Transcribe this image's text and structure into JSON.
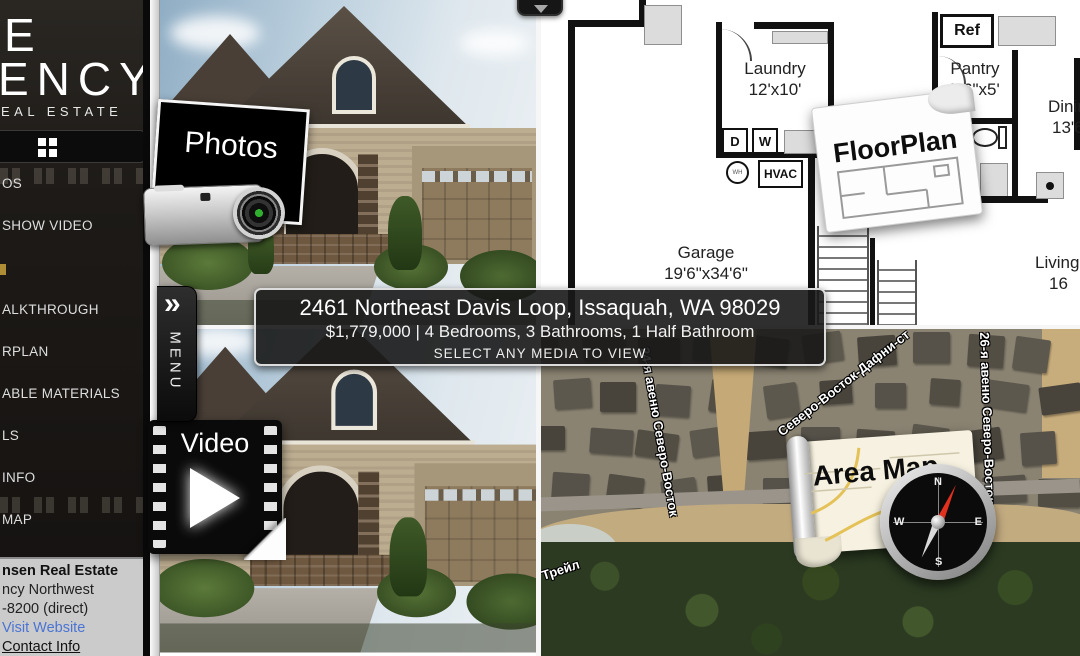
{
  "brand": {
    "logo_line1": "E",
    "logo_line2": "ENCY",
    "logo_line3": "EAL ESTATE"
  },
  "sidebar": {
    "items": [
      {
        "label": "OS"
      },
      {
        "label": "SHOW VIDEO"
      },
      {
        "label": "ALKTHROUGH"
      },
      {
        "label": "RPLAN"
      },
      {
        "label": "ABLE MATERIALS"
      },
      {
        "label": "LS"
      },
      {
        "label": "INFO"
      },
      {
        "label": "MAP"
      }
    ],
    "contact": {
      "line1": "nsen Real Estate",
      "line2": "ncy Northwest",
      "line3": "-8200 (direct)",
      "website_link": "Visit Website",
      "contact_link": "Contact Info"
    }
  },
  "menu_tab": {
    "label": "MENU"
  },
  "banner": {
    "address": "2461 Northeast Davis Loop, Issaquah, WA 98029",
    "price_line": "$1,779,000 | 4 Bedrooms, 3 Bathrooms, 1 Half Bathroom",
    "hint": "SELECT ANY MEDIA TO VIEW"
  },
  "media": {
    "photos_label": "Photos",
    "video_label": "Video",
    "floorplan_label": "FloorPlan",
    "areamap_label": "Area Map"
  },
  "compass": {
    "n": "N",
    "e": "E",
    "s": "S",
    "w": "W"
  },
  "floorplan": {
    "rooms": {
      "laundry": {
        "name": "Laundry",
        "dims": "12'x10'"
      },
      "pantry": {
        "name": "Pantry",
        "dims": "5'6\"x5'"
      },
      "half_bath": {
        "name_line1": "Half",
        "name_line2": "Bath",
        "dims": "5'6\"x5'6\""
      },
      "garage": {
        "name": "Garage",
        "dims": "19'6\"x34'6\""
      },
      "dining": {
        "name": "Dining",
        "dims": "13'6"
      },
      "living": {
        "name": "Living",
        "dims": "16"
      }
    },
    "fixtures": {
      "ref": "Ref",
      "dryer": "D",
      "washer": "W",
      "water_heater": "WH",
      "hvac": "HVAC"
    }
  },
  "map": {
    "street_labels": [
      "24-я авеню Северо-Восток",
      "Северо-Восток-Дафни-ст",
      "26-я авеню Северо-Восток",
      "н Трейл"
    ]
  },
  "colors": {
    "link_blue": "#4a74d4",
    "banner_text": "#ffffff",
    "needle_red": "#e0301e",
    "lens_green": "#2fae2f"
  }
}
